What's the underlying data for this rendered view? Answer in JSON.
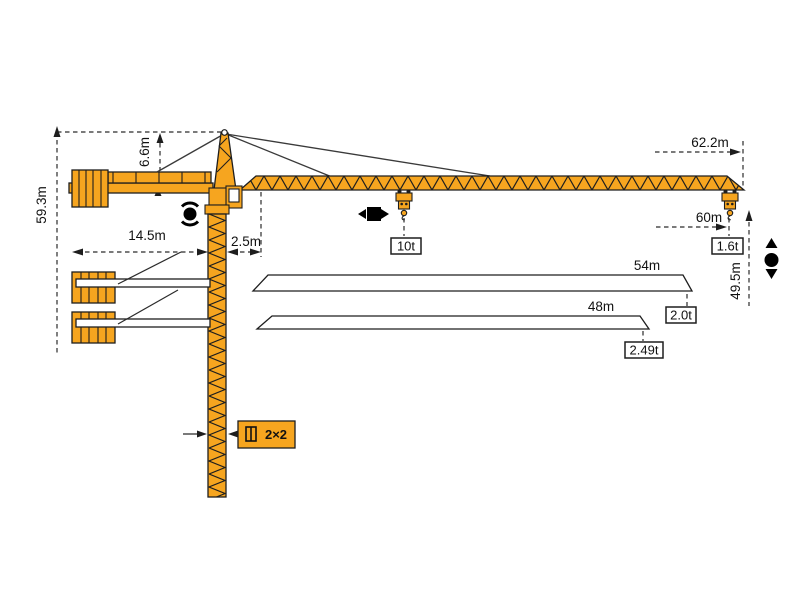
{
  "diagram": {
    "title": "tower-crane-dimension-diagram",
    "labels": {
      "total_height": "59.3m",
      "apex_height": "6.6m",
      "counterjib_radius": "14.5m",
      "rear_offset": "2.5m",
      "overall_tip_radius": "62.2m",
      "working_radius_60": "60m",
      "hook_height": "49.5m",
      "jib_54": "54m",
      "jib_48": "48m",
      "max_load": "10t",
      "tip_load_60": "1.6t",
      "tip_load_54": "2.0t",
      "tip_load_48": "2.49t",
      "mast_section": "2×2"
    },
    "jib_variants": [
      {
        "length": "60m",
        "tip_load": "1.6t"
      },
      {
        "length": "54m",
        "tip_load": "2.0t"
      },
      {
        "length": "48m",
        "tip_load": "2.49t"
      }
    ],
    "icons": {
      "slewing": "rotation-dot-with-arc-arrows",
      "trolley_travel": "left-right-arrows-square",
      "hoisting": "up-down-arrows-dot",
      "mast_section": "square-cross-section-symbol"
    },
    "colors": {
      "crane_orange": "#F6A51F",
      "line_black": "#1e1e1e",
      "background": "#ffffff"
    }
  }
}
